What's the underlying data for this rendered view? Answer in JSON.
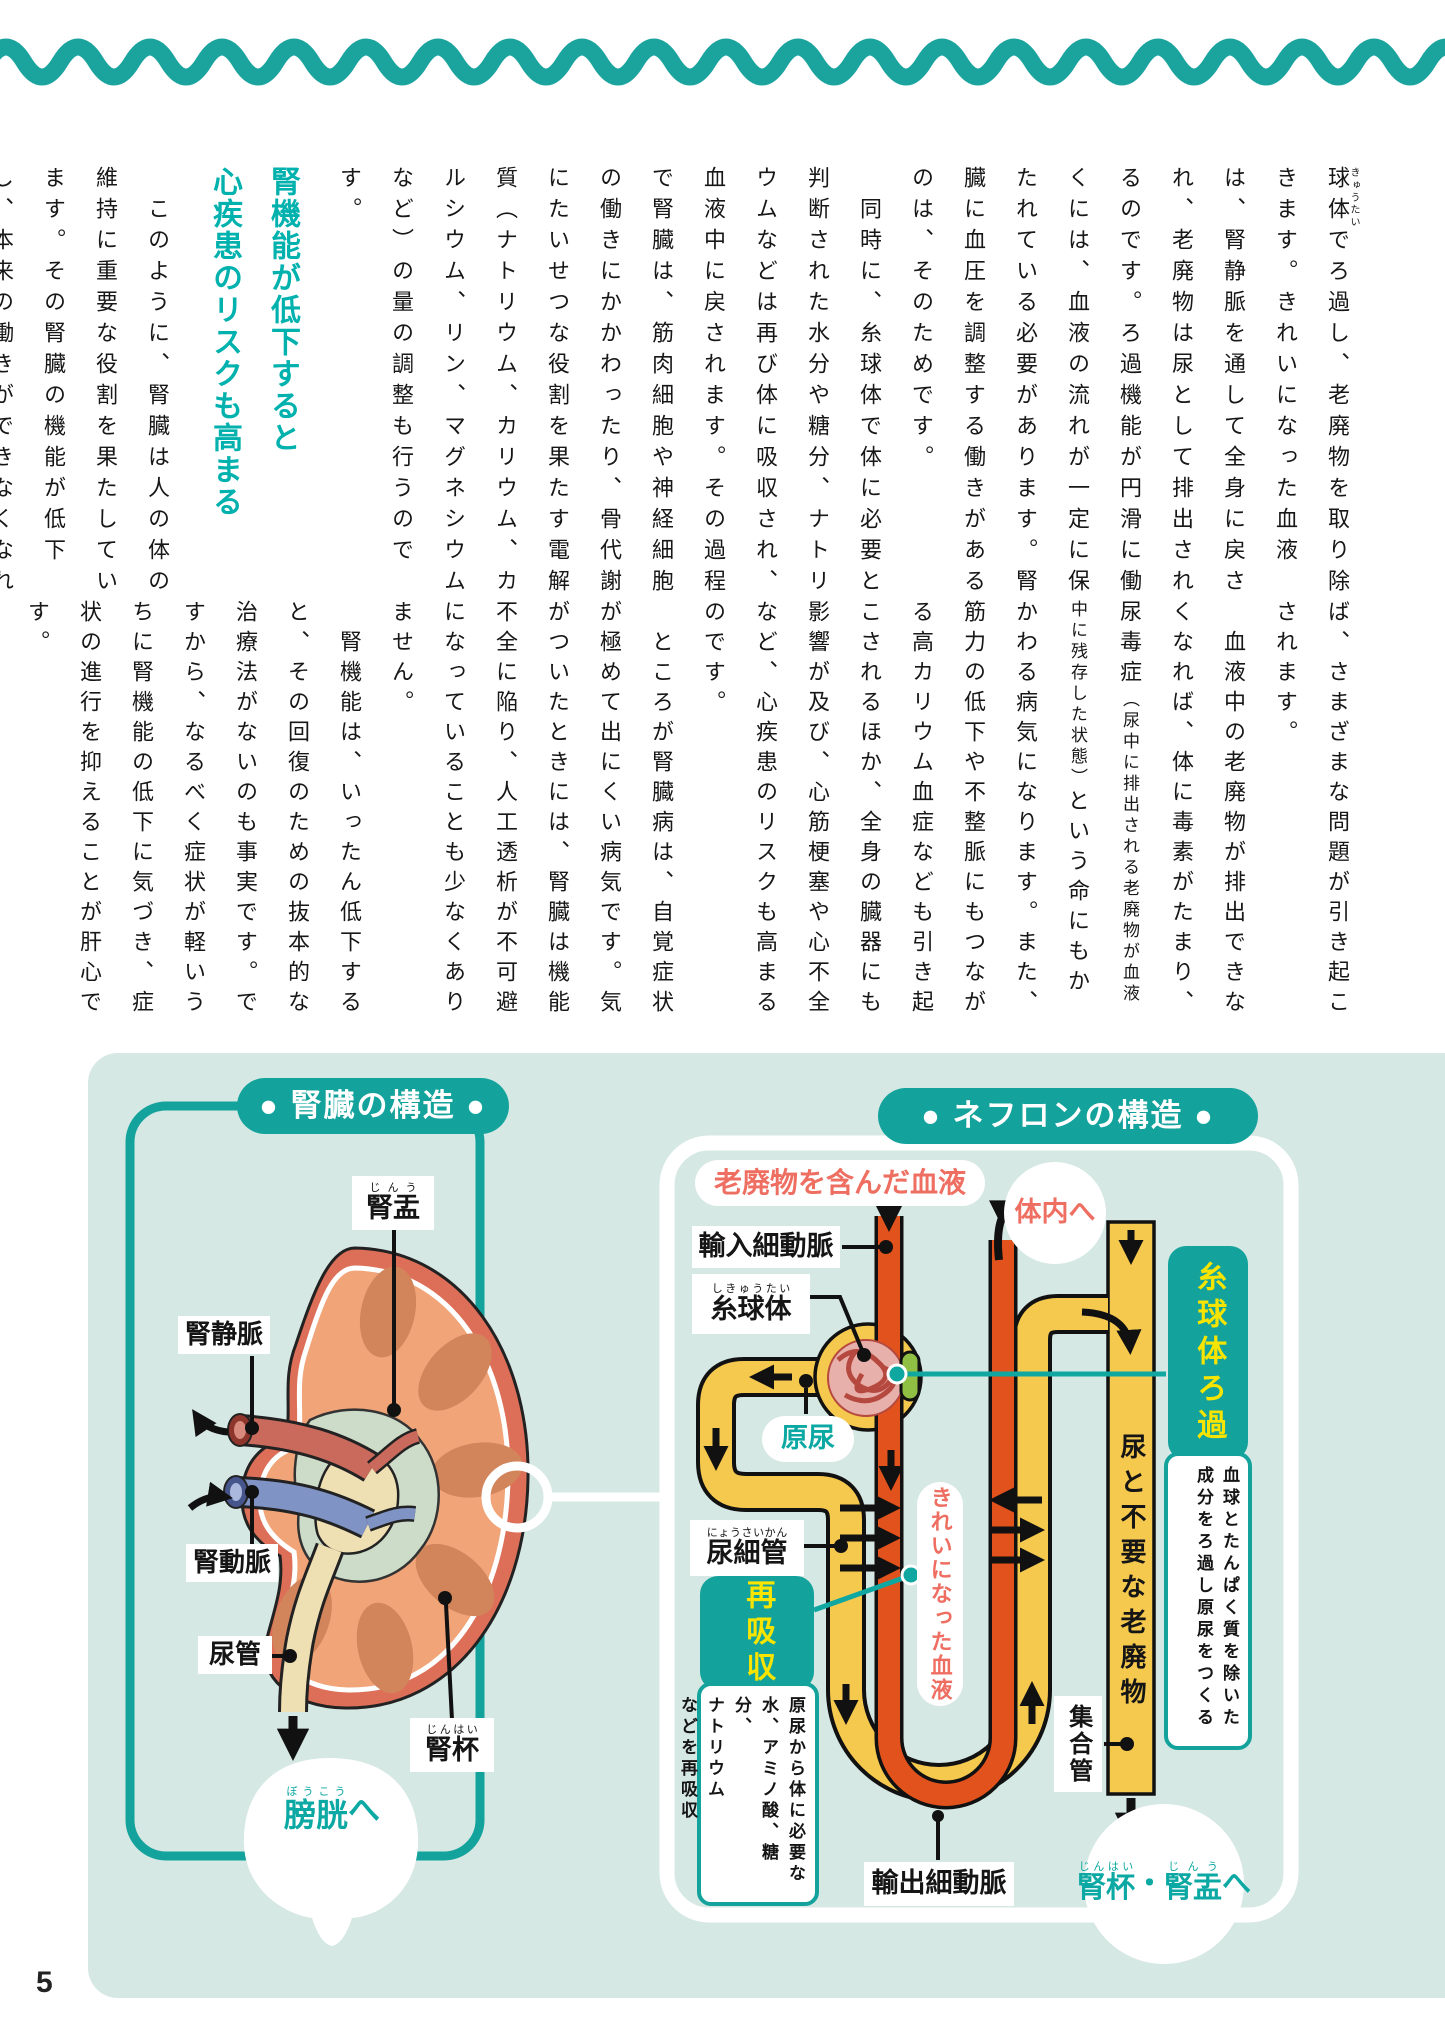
{
  "page": {
    "number": "5"
  },
  "colors": {
    "teal": "#14a39c",
    "heading_teal": "#00b1ad",
    "panel_bg": "#d5e8e3",
    "coral": "#ef6e62",
    "tube_yellow": "#f5c84e",
    "vessel_orange": "#e2521c",
    "green_segment": "#8fc043",
    "highlight_yellow": "#f7e400"
  },
  "article": {
    "p1_html": "<ruby>球体<rt>きゅうたい</rt></ruby>でろ過し、老廃物を取り除きます。きれいになった血液は、腎静脈を通して全身に戻され、老廃物は尿として排出されるのです。ろ過機能が円滑に働くには、血液の流れが一定に保たれている必要があります。腎臓に血圧を調整する働きがあるのは、そのためです。",
    "p2": "　同時に、糸球体で体に必要と判断された水分や糖分、ナトリウムなどは再び体に吸収され、血液中に戻されます。その過程で腎臓は、筋肉細胞や神経細胞の働きにかかわったり、骨代謝にたいせつな役割を果たす電解質（ナトリウム、カリウム、カルシウム、リン、マグネシウムなど）の量の調整も行うのです。",
    "heading_line1": "腎機能が低下すると",
    "heading_line2": "心疾患のリスクも高まる",
    "p3a": "　このように、腎臓は人の体の維持に重要な役割を果たしています。その腎臓の機能が低下し、本来の働きができなくなれ",
    "p3b": "ば、さまざまな問題が引き起こされます。",
    "p4_html": "　血液中の老廃物が排出できなくなれば、体に毒素がたまり、尿毒症<span class=\"sm\">（尿中に排出される老廃物が血液中に残存した状態）</span>という命にもかかわる病気になります。また、筋力の低下や不整脈にもつながる高カリウム血症なども引き起こされるほか、全身の臓器にも影響が及び、心筋梗塞や心不全など、心疾患のリスクも高まるのです。",
    "p5": "　ところが腎臓病は、自覚症状が極めて出にくい病気です。気がついたときには、腎臓は機能不全に陥り、人工透析が不可避になっていることも少なくありません。",
    "p6": "　腎機能は、いったん低下すると、その回復のための抜本的な治療法がないのも事実です。ですから、なるべく症状が軽いうちに腎機能の低下に気づき、症状の進行を抑えることが肝心です。"
  },
  "kidney": {
    "title": "● 腎臓の構造 ●",
    "label_renal_pelvis_html": "<ruby>腎盂<rt>じんう</rt></ruby>",
    "label_renal_vein": "腎静脈",
    "label_renal_artery": "腎動脈",
    "label_ureter": "尿管",
    "label_renal_calyx_html": "<ruby>腎杯<rt>じんはい</rt></ruby>",
    "label_to_bladder_html": "<ruby>膀胱<rt>ぼうこう</rt></ruby>へ"
  },
  "nephron": {
    "title": "● ネフロンの構造 ●",
    "label_dirty_blood": "老廃物を含んだ血液",
    "label_to_body": "体内へ",
    "label_afferent_arteriole": "輸入細動脈",
    "label_glomerulus_html": "<ruby>糸球体<rt>しきゅうたい</rt></ruby>",
    "label_primitive_urine": "原尿",
    "filtration_title": "糸球体ろ過",
    "filtration_desc_html": "血球とたんぱく質を除いた<br>成分をろ過し原尿をつくる",
    "label_urine_waste_band": "尿と不要な老廃物",
    "label_tubule_html": "<ruby>尿細管<rt>にょうさいかん</rt></ruby>",
    "reabsorption_title": "再吸収",
    "reabsorption_desc_html": "原尿から体に必要な<br>水、アミノ酸、糖分、<br>ナトリウム<br>などを再吸収",
    "label_clean_blood": "きれいになった血液",
    "label_collecting_duct": "集合管",
    "label_efferent_arteriole": "輸出細動脈",
    "label_to_calyx_pelvis_html": "<ruby>腎杯<rt>じんはい</rt></ruby>・<br><ruby>腎盂<rt>じんう</rt></ruby>へ"
  }
}
